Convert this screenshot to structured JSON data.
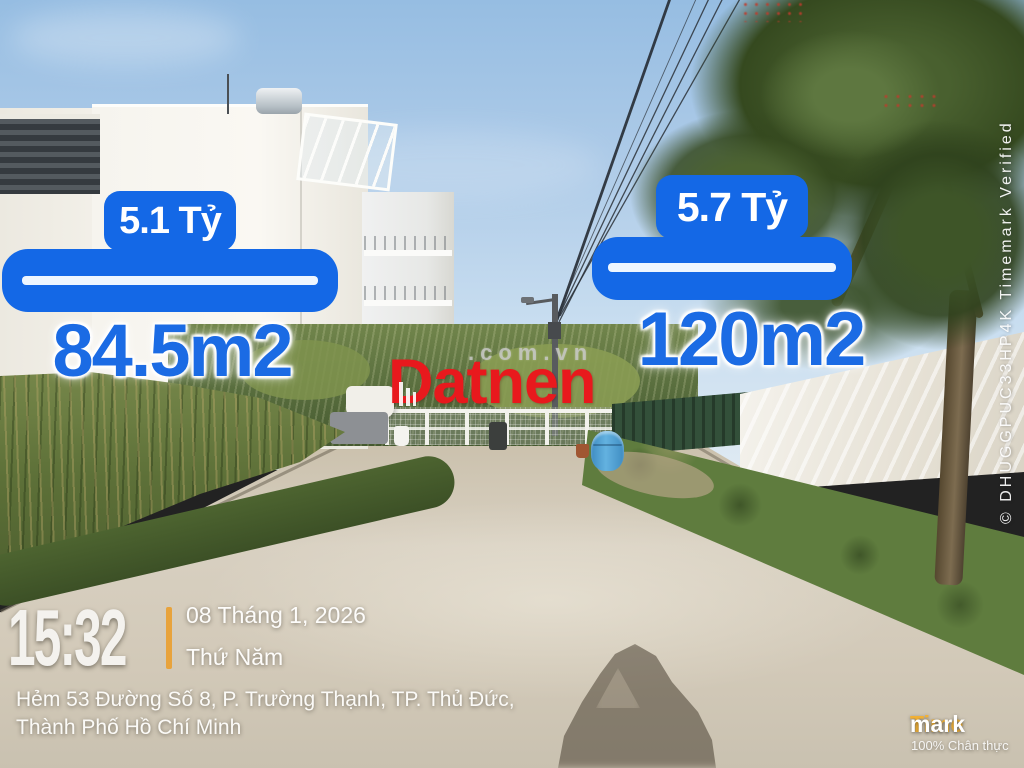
{
  "left_listing": {
    "price": "5.1 Tỷ",
    "area": "84.5m2"
  },
  "right_listing": {
    "price": "5.7 Tỷ",
    "area": "120m2"
  },
  "watermark": {
    "brand": "Datnen",
    "domain_suffix": ".com.vn"
  },
  "timestamp": {
    "time": "15:32",
    "date": "08 Tháng 1, 2026",
    "weekday": "Thứ Năm"
  },
  "address": {
    "line1": "Hẻm 53 Đường Số 8, P. Trường Thạnh, TP. Thủ Đức,",
    "line2": "Thành Phố Hồ Chí Minh"
  },
  "timemark": {
    "brand_part1": "Time",
    "brand_part2": "mark",
    "tagline": "100% Chân thực"
  },
  "verification": {
    "vertical_text": "© DHUGGPUC33HP4K   Timemark Verified"
  },
  "colors": {
    "overlay_blue": "#1468e6",
    "brand_red": "#e8191d",
    "timemark_orange": "#f2b135",
    "divider_orange": "#e8a33c"
  }
}
